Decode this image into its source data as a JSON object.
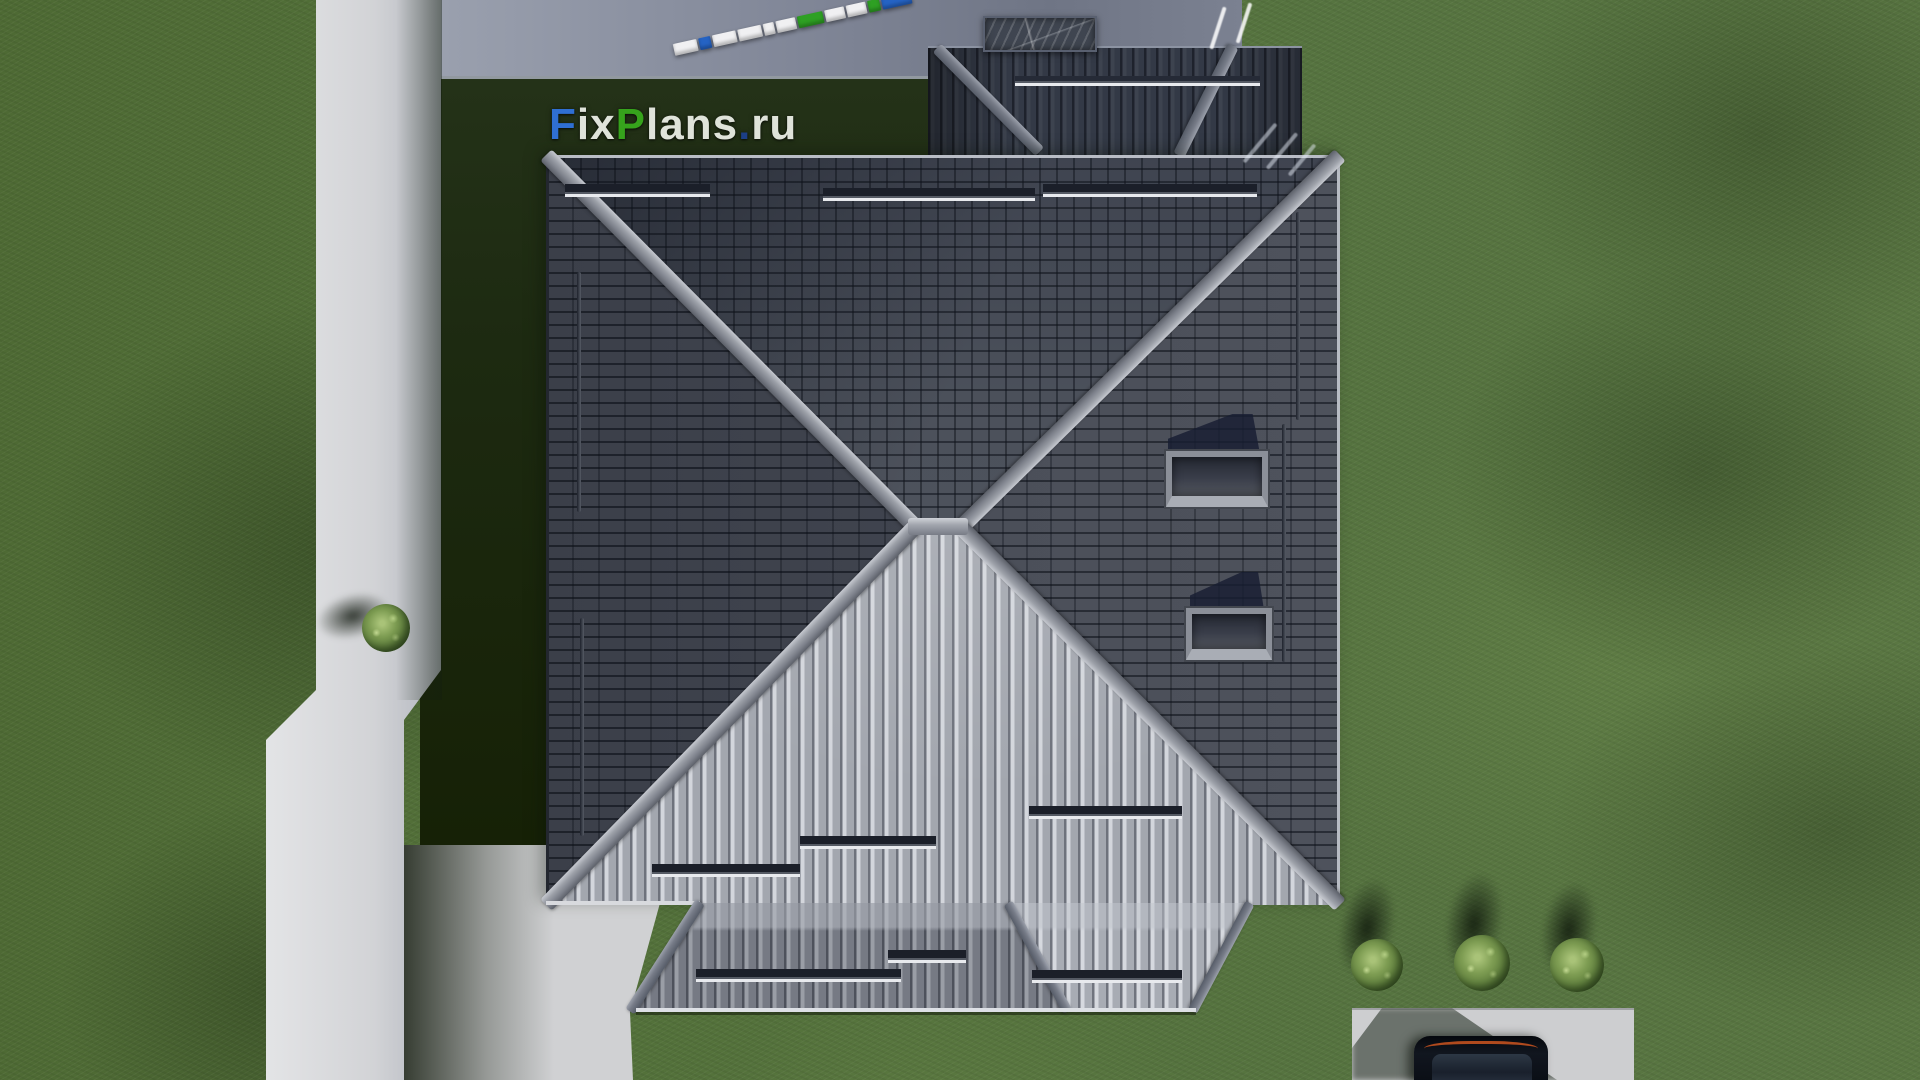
{
  "watermark": {
    "text": "FixPlans.ru",
    "letters": [
      {
        "ch": "F",
        "color": "#2f6fd2"
      },
      {
        "ch": "i",
        "color": "#dfe3da"
      },
      {
        "ch": "x",
        "color": "#dfe3da"
      },
      {
        "ch": "P",
        "color": "#36a31c"
      },
      {
        "ch": "l",
        "color": "#dfe3da"
      },
      {
        "ch": "a",
        "color": "#dfe3da"
      },
      {
        "ch": "n",
        "color": "#dfe3da"
      },
      {
        "ch": "s",
        "color": "#dfe3da"
      },
      {
        "ch": ".",
        "color": "#1c3f86"
      },
      {
        "ch": "r",
        "color": "#dfe3da"
      },
      {
        "ch": "u",
        "color": "#dfe3da"
      }
    ]
  },
  "scene": {
    "type": "aerial-3d-render",
    "subject": "hip-roof house top view on grass lot",
    "objects": {
      "main_roof": "square hipped roof with central ridge, gray tiles",
      "wing_roof": "garage wing roof at top with valley and hip",
      "apron_roof": "lower terrace roof strip along bottom eave",
      "skylights": 2,
      "chimney": "marble-textured chimney cap on driveway side",
      "snow_guards": 9,
      "roof_rails": 4,
      "bushes": 4,
      "car": "dark car on concrete parking pad, bottom right",
      "ruler": "surveyor staff lying on driveway",
      "path": "light concrete walkway, left side",
      "driveway": "blue-gray concrete strip, top",
      "patio": "concrete patio at house south-west corner"
    }
  },
  "ruler": {
    "segments": [
      {
        "color": "#f0f0f2",
        "w": 24
      },
      {
        "color": "#2563c4",
        "w": 12
      },
      {
        "color": "#f0f0f2",
        "w": 24
      },
      {
        "color": "#f0f0f2",
        "w": 24
      },
      {
        "color": "#f0f0f2",
        "w": 11
      },
      {
        "color": "#f0f0f2",
        "w": 20
      },
      {
        "color": "#2ea023",
        "w": 26
      },
      {
        "color": "#f0f0f2",
        "w": 20
      },
      {
        "color": "#f0f0f2",
        "w": 20
      },
      {
        "color": "#2ea023",
        "w": 12
      },
      {
        "color": "#2563c4",
        "w": 30
      }
    ]
  },
  "colors": {
    "grass_base": "#53713a",
    "grass_shadow": "#1d2a11",
    "path_concrete": "#d2d3d6",
    "driveway_concrete": "#828899",
    "roof_dark_slope": "#454954",
    "roof_bright_slope": "#a3a7af",
    "ridge_bar": "#a2a6ae",
    "wing_roof": "#333946",
    "skylight_glass": "#2c303a",
    "snow_guard_bar": "#1b1f29",
    "snow_guard_rail": "#e8eaee",
    "bush_green": "#7d9c52",
    "car_body": "#0a0e15",
    "car_taillight": "#c2511f",
    "logo_blue": "#2f6fd2",
    "logo_green": "#36a31c",
    "logo_white": "#dfe3da"
  }
}
